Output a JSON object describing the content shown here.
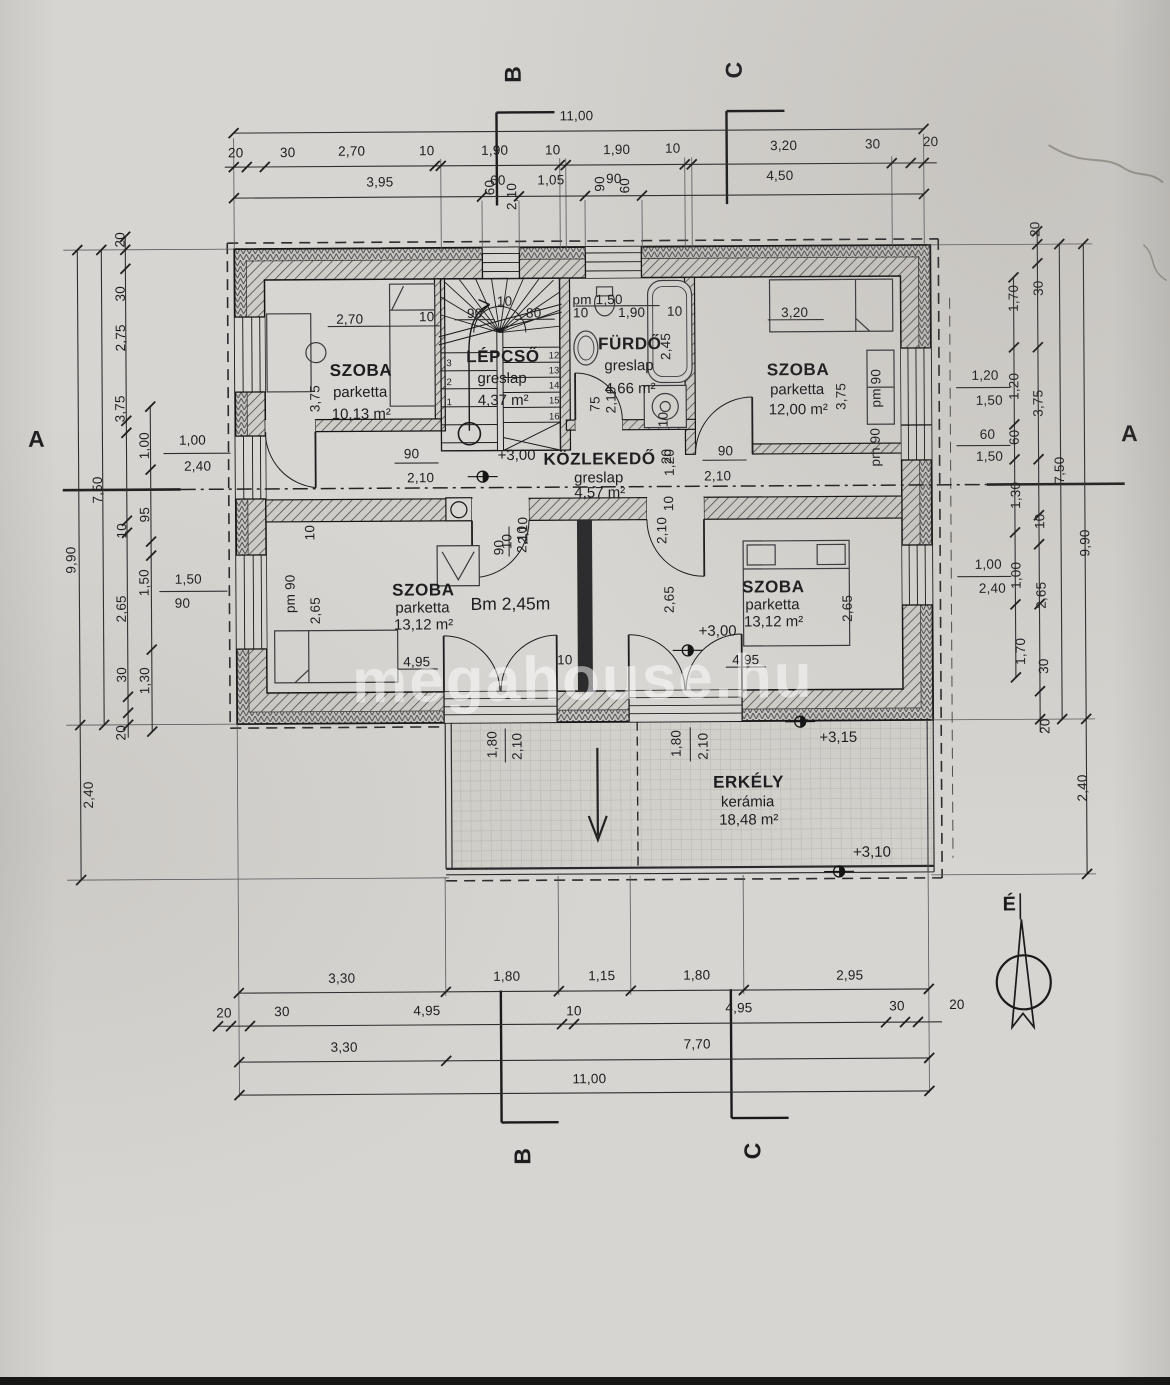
{
  "document": {
    "kind": "floor plan (emeleti alaprajz)",
    "language": "Hungarian"
  },
  "watermark": {
    "text": "megahouse.hu"
  },
  "compass": {
    "label": "É"
  },
  "ceiling": {
    "text": "Bm 2,45m",
    "x": 511,
    "y": 604
  },
  "colors": {
    "paper": "#d7d5d1",
    "ink": "#1d1d20",
    "watermark": "rgba(255,255,255,0.5)"
  },
  "rooms": [
    {
      "name": "SZOBA",
      "floor": "parketta",
      "area": "10,13 m²",
      "cx": 363,
      "ys": [
        369,
        391,
        413
      ]
    },
    {
      "name": "LÉPCSŐ",
      "floor": "greslap",
      "area": "4,37 m²",
      "cx": 505,
      "ys": [
        356,
        378,
        400
      ]
    },
    {
      "name": "FÜRDŐ",
      "floor": "greslap",
      "area": "4,66 m²",
      "cx": 632,
      "ys": [
        344,
        366,
        389
      ]
    },
    {
      "name": "SZOBA",
      "floor": "parketta",
      "area": "12,00 m²",
      "cx": 800,
      "ys": [
        371,
        391,
        411
      ]
    },
    {
      "name": "KÖZLEKEDŐ",
      "floor": "greslap",
      "area": "4,57 m²",
      "cx": 601,
      "ys": [
        459,
        478,
        493
      ]
    },
    {
      "name": "SZOBA",
      "floor": "parketta",
      "area": "13,12 m²",
      "cx": 424,
      "ys": [
        589,
        607,
        624
      ]
    },
    {
      "name": "SZOBA",
      "floor": "parketta",
      "area": "13,12 m²",
      "cx": 774,
      "ys": [
        588,
        606,
        623
      ]
    },
    {
      "name": "ERKÉLY",
      "floor": "kerámia",
      "area": "18,48 m²",
      "cx": 748,
      "ys": [
        783,
        803,
        821
      ]
    }
  ],
  "levels": [
    {
      "t": "+3,00",
      "x": 518,
      "y": 455
    },
    {
      "t": "+3,00",
      "x": 718,
      "y": 632
    },
    {
      "t": "+3,15",
      "x": 838,
      "y": 739
    },
    {
      "t": "+3,10",
      "x": 871,
      "y": 854
    }
  ],
  "sections": [
    {
      "t": "A",
      "x": 38,
      "y": 436,
      "r": 0
    },
    {
      "t": "A",
      "x": 1131,
      "y": 437,
      "r": 0
    },
    {
      "t": "B",
      "x": 517,
      "y": 74,
      "r": -90
    },
    {
      "t": "C",
      "x": 738,
      "y": 71,
      "r": -90
    },
    {
      "t": "B",
      "x": 520,
      "y": 1156,
      "r": -90
    },
    {
      "t": "C",
      "x": 750,
      "y": 1152,
      "r": -90
    }
  ],
  "dims": {
    "labels": [
      {
        "t": "11,00",
        "x": 580,
        "y": 116
      },
      {
        "t": "20",
        "x": 239,
        "y": 151
      },
      {
        "t": "30",
        "x": 291,
        "y": 151
      },
      {
        "t": "2,70",
        "x": 355,
        "y": 150
      },
      {
        "t": "10",
        "x": 430,
        "y": 150
      },
      {
        "t": "1,90",
        "x": 498,
        "y": 150
      },
      {
        "t": "10",
        "x": 556,
        "y": 150
      },
      {
        "t": "1,90",
        "x": 620,
        "y": 150
      },
      {
        "t": "10",
        "x": 676,
        "y": 149
      },
      {
        "t": "3,20",
        "x": 787,
        "y": 147
      },
      {
        "t": "30",
        "x": 876,
        "y": 146
      },
      {
        "t": "20",
        "x": 934,
        "y": 144
      },
      {
        "t": "3,95",
        "x": 383,
        "y": 181
      },
      {
        "t": "60",
        "x": 501,
        "y": 180
      },
      {
        "t": "1,05",
        "x": 554,
        "y": 180
      },
      {
        "t": "90",
        "x": 617,
        "y": 179
      },
      {
        "t": "4,50",
        "x": 783,
        "y": 177
      },
      {
        "t": "60",
        "x": 493,
        "y": 187,
        "r": -90
      },
      {
        "t": "2,10",
        "x": 515,
        "y": 196,
        "r": -90
      },
      {
        "t": "90",
        "x": 603,
        "y": 184,
        "r": -90
      },
      {
        "t": "60",
        "x": 628,
        "y": 186,
        "r": -90
      },
      {
        "t": "3,30",
        "x": 340,
        "y": 977
      },
      {
        "t": "1,80",
        "x": 505,
        "y": 976
      },
      {
        "t": "1,15",
        "x": 600,
        "y": 976
      },
      {
        "t": "1,80",
        "x": 695,
        "y": 976
      },
      {
        "t": "2,95",
        "x": 848,
        "y": 977
      },
      {
        "t": "20",
        "x": 222,
        "y": 1011
      },
      {
        "t": "30",
        "x": 280,
        "y": 1010
      },
      {
        "t": "4,95",
        "x": 425,
        "y": 1010
      },
      {
        "t": "10",
        "x": 572,
        "y": 1011
      },
      {
        "t": "4,95",
        "x": 737,
        "y": 1009
      },
      {
        "t": "30",
        "x": 895,
        "y": 1008
      },
      {
        "t": "20",
        "x": 955,
        "y": 1007
      },
      {
        "t": "3,30",
        "x": 342,
        "y": 1046
      },
      {
        "t": "7,70",
        "x": 695,
        "y": 1045
      },
      {
        "t": "11,00",
        "x": 587,
        "y": 1079
      },
      {
        "t": "9,90",
        "x": 72,
        "y": 557,
        "r": -90
      },
      {
        "t": "2,40",
        "x": 88,
        "y": 792,
        "r": -90
      },
      {
        "t": "7,50",
        "x": 99,
        "y": 487,
        "r": -90
      },
      {
        "t": "20",
        "x": 123,
        "y": 237,
        "r": -90
      },
      {
        "t": "30",
        "x": 123,
        "y": 291,
        "r": -90
      },
      {
        "t": "2,75",
        "x": 123,
        "y": 335,
        "r": -90
      },
      {
        "t": "3,75",
        "x": 122,
        "y": 406,
        "r": -90
      },
      {
        "t": "10",
        "x": 123,
        "y": 528,
        "r": -90
      },
      {
        "t": "2,65",
        "x": 122,
        "y": 606,
        "r": -90
      },
      {
        "t": "30",
        "x": 122,
        "y": 672,
        "r": -90
      },
      {
        "t": "20",
        "x": 121,
        "y": 730,
        "r": -90
      },
      {
        "t": "1,00",
        "x": 146,
        "y": 443,
        "r": -90
      },
      {
        "t": "95",
        "x": 146,
        "y": 512,
        "r": -90
      },
      {
        "t": "1,50",
        "x": 145,
        "y": 580,
        "r": -90
      },
      {
        "t": "1,30",
        "x": 145,
        "y": 678,
        "r": -90
      },
      {
        "t": "1,00",
        "x": 194,
        "y": 438
      },
      {
        "t": "2,40",
        "x": 199,
        "y": 464
      },
      {
        "t": "1,50",
        "x": 189,
        "y": 577
      },
      {
        "t": "90",
        "x": 183,
        "y": 601
      },
      {
        "t": "1,70",
        "x": 1016,
        "y": 301,
        "r": -90
      },
      {
        "t": "1,20",
        "x": 1016,
        "y": 389,
        "r": -90
      },
      {
        "t": "60",
        "x": 1016,
        "y": 440,
        "r": -90
      },
      {
        "t": "1,30",
        "x": 1017,
        "y": 498,
        "r": -90
      },
      {
        "t": "1,00",
        "x": 1017,
        "y": 578,
        "r": -90
      },
      {
        "t": "1,70",
        "x": 1021,
        "y": 654,
        "r": -90
      },
      {
        "t": "20",
        "x": 1038,
        "y": 232,
        "r": -90
      },
      {
        "t": "30",
        "x": 1041,
        "y": 291,
        "r": -90
      },
      {
        "t": "3,75",
        "x": 1040,
        "y": 406,
        "r": -90
      },
      {
        "t": "10",
        "x": 1041,
        "y": 524,
        "r": -90
      },
      {
        "t": "2,65",
        "x": 1042,
        "y": 598,
        "r": -90
      },
      {
        "t": "30",
        "x": 1044,
        "y": 669,
        "r": -90
      },
      {
        "t": "20",
        "x": 1045,
        "y": 729,
        "r": -90
      },
      {
        "t": "7,50",
        "x": 1061,
        "y": 473,
        "r": -90
      },
      {
        "t": "9,90",
        "x": 1086,
        "y": 546,
        "r": -90
      },
      {
        "t": "2,40",
        "x": 1082,
        "y": 791,
        "r": -90
      },
      {
        "t": "1,20",
        "x": 987,
        "y": 378
      },
      {
        "t": "1,50",
        "x": 991,
        "y": 403
      },
      {
        "t": "60",
        "x": 989,
        "y": 437
      },
      {
        "t": "1,50",
        "x": 991,
        "y": 459
      },
      {
        "t": "1,00",
        "x": 989,
        "y": 567
      },
      {
        "t": "2,40",
        "x": 993,
        "y": 591
      },
      {
        "t": "2,70",
        "x": 352,
        "y": 318
      },
      {
        "t": "10",
        "x": 429,
        "y": 316
      },
      {
        "t": "3,75",
        "x": 317,
        "y": 397,
        "r": -90
      },
      {
        "t": "90",
        "x": 477,
        "y": 313
      },
      {
        "t": "10",
        "x": 507,
        "y": 301
      },
      {
        "t": "80",
        "x": 536,
        "y": 313
      },
      {
        "t": "12",
        "x": 556,
        "y": 356,
        "s": "tiny"
      },
      {
        "t": "13",
        "x": 556,
        "y": 371,
        "s": "tiny"
      },
      {
        "t": "14",
        "x": 556,
        "y": 386,
        "s": "tiny"
      },
      {
        "t": "15",
        "x": 556,
        "y": 401,
        "s": "tiny"
      },
      {
        "t": "16",
        "x": 556,
        "y": 417,
        "s": "tiny"
      },
      {
        "t": "3",
        "x": 451,
        "y": 363,
        "s": "tiny"
      },
      {
        "t": "2",
        "x": 451,
        "y": 382,
        "s": "tiny"
      },
      {
        "t": "1",
        "x": 451,
        "y": 402,
        "s": "tiny"
      },
      {
        "t": "pm 1,50",
        "x": 600,
        "y": 300
      },
      {
        "t": "10",
        "x": 583,
        "y": 313
      },
      {
        "t": "1,90",
        "x": 634,
        "y": 313
      },
      {
        "t": "10",
        "x": 677,
        "y": 312
      },
      {
        "t": "2,45",
        "x": 668,
        "y": 347,
        "r": -90
      },
      {
        "t": "2,10",
        "x": 613,
        "y": 400,
        "r": -90
      },
      {
        "t": "75",
        "x": 597,
        "y": 404,
        "r": -90
      },
      {
        "t": "10",
        "x": 665,
        "y": 420,
        "r": -90
      },
      {
        "t": "20",
        "x": 668,
        "y": 457,
        "r": -90
      },
      {
        "t": "3,20",
        "x": 797,
        "y": 314
      },
      {
        "t": "3,75",
        "x": 843,
        "y": 398,
        "r": -90
      },
      {
        "t": "pm 90",
        "x": 878,
        "y": 390,
        "r": -90
      },
      {
        "t": "pm 90",
        "x": 877,
        "y": 449,
        "r": -90
      },
      {
        "t": "90",
        "x": 413,
        "y": 453
      },
      {
        "t": "2,10",
        "x": 422,
        "y": 477
      },
      {
        "t": "90",
        "x": 727,
        "y": 452
      },
      {
        "t": "2,10",
        "x": 719,
        "y": 477
      },
      {
        "t": "1,20",
        "x": 671,
        "y": 463,
        "r": -90
      },
      {
        "t": "10",
        "x": 670,
        "y": 504,
        "r": -90
      },
      {
        "t": "2,10",
        "x": 663,
        "y": 531,
        "r": -90
      },
      {
        "t": "2,10",
        "x": 524,
        "y": 530,
        "r": -90
      },
      {
        "t": "10",
        "x": 508,
        "y": 541,
        "r": -90
      },
      {
        "t": "4,95",
        "x": 417,
        "y": 661
      },
      {
        "t": "2,65",
        "x": 316,
        "y": 609,
        "r": -90
      },
      {
        "t": "pm 90",
        "x": 291,
        "y": 592,
        "r": -90
      },
      {
        "t": "10",
        "x": 311,
        "y": 531,
        "r": -90
      },
      {
        "t": "90",
        "x": 500,
        "y": 547,
        "r": -90
      },
      {
        "t": "2,10",
        "x": 523,
        "y": 539,
        "r": -90
      },
      {
        "t": "10",
        "x": 565,
        "y": 660
      },
      {
        "t": "4,95",
        "x": 746,
        "y": 661
      },
      {
        "t": "2,65",
        "x": 670,
        "y": 600,
        "r": -90
      },
      {
        "t": "2,65",
        "x": 848,
        "y": 610,
        "r": -90
      },
      {
        "t": "1,80",
        "x": 492,
        "y": 744,
        "r": -90
      },
      {
        "t": "2,10",
        "x": 517,
        "y": 746,
        "r": -90
      },
      {
        "t": "1,80",
        "x": 676,
        "y": 744,
        "r": -90
      },
      {
        "t": "2,10",
        "x": 703,
        "y": 747,
        "r": -90
      }
    ]
  }
}
